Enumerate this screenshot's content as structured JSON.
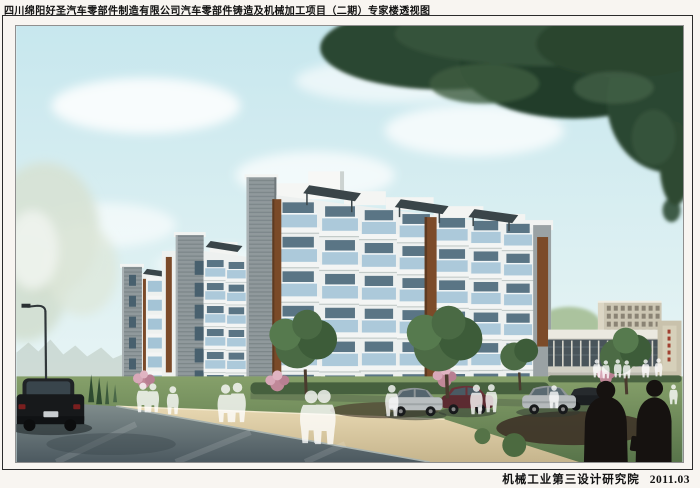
{
  "sheet": {
    "title": "四川绵阳好圣汽车零部件制造有限公司汽车零部件铸造及机械加工项目（二期）专家楼透视图",
    "institute": "机械工业第三设计研究院",
    "date": "2011.03"
  },
  "scene": {
    "type": "architectural-perspective-rendering",
    "subject": "专家楼透视图"
  },
  "colors": {
    "page": "#f8f5f1",
    "frame": "#2b2b2b",
    "sky": "#cdeaee",
    "foliage_dark": "#2c4731",
    "facade_white": "#eff1ef",
    "facade_gray": "#90999c",
    "wood_panel": "#7a4a28",
    "glass": "#a6c6d8",
    "road": "#5f6b70",
    "sidewalk": "#dcc9a2",
    "lawn": "#6f8c58"
  }
}
